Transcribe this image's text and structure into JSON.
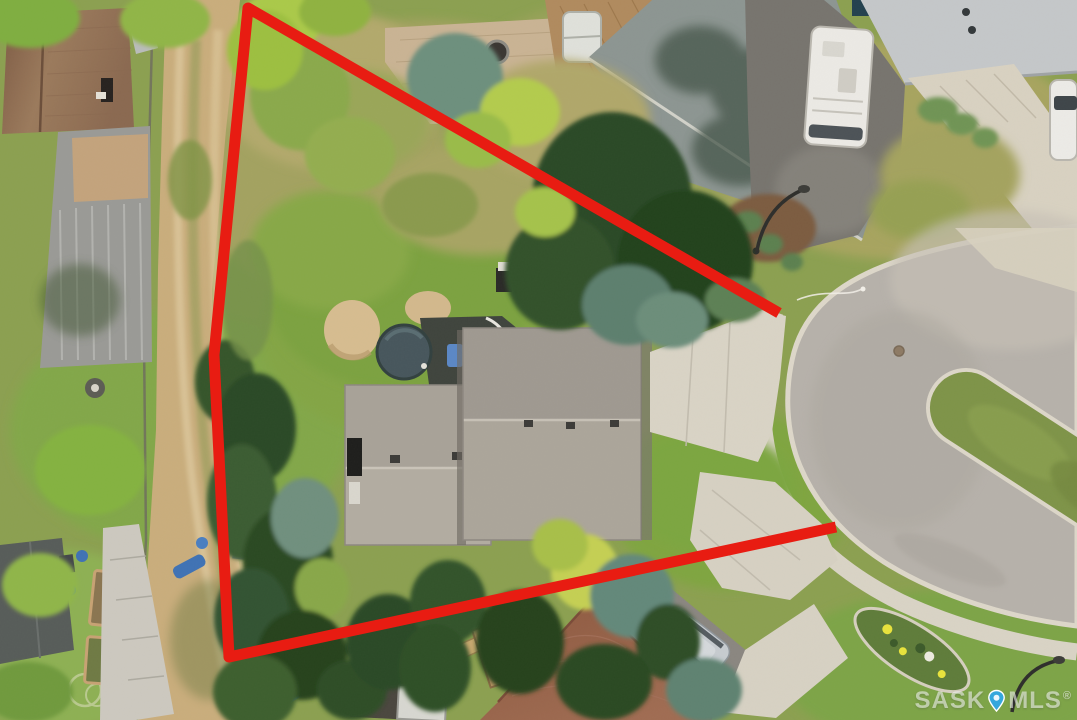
{
  "watermark": {
    "prefix": "SASK",
    "suffix": "MLS",
    "registered": "®",
    "pin_fill": "#35a7dc",
    "pin_stroke": "#ffffff"
  },
  "boundary": {
    "color": "#e81c12",
    "stroke_width": 11,
    "points": "779,313 248,8 214,355 229,657 836,527"
  }
}
